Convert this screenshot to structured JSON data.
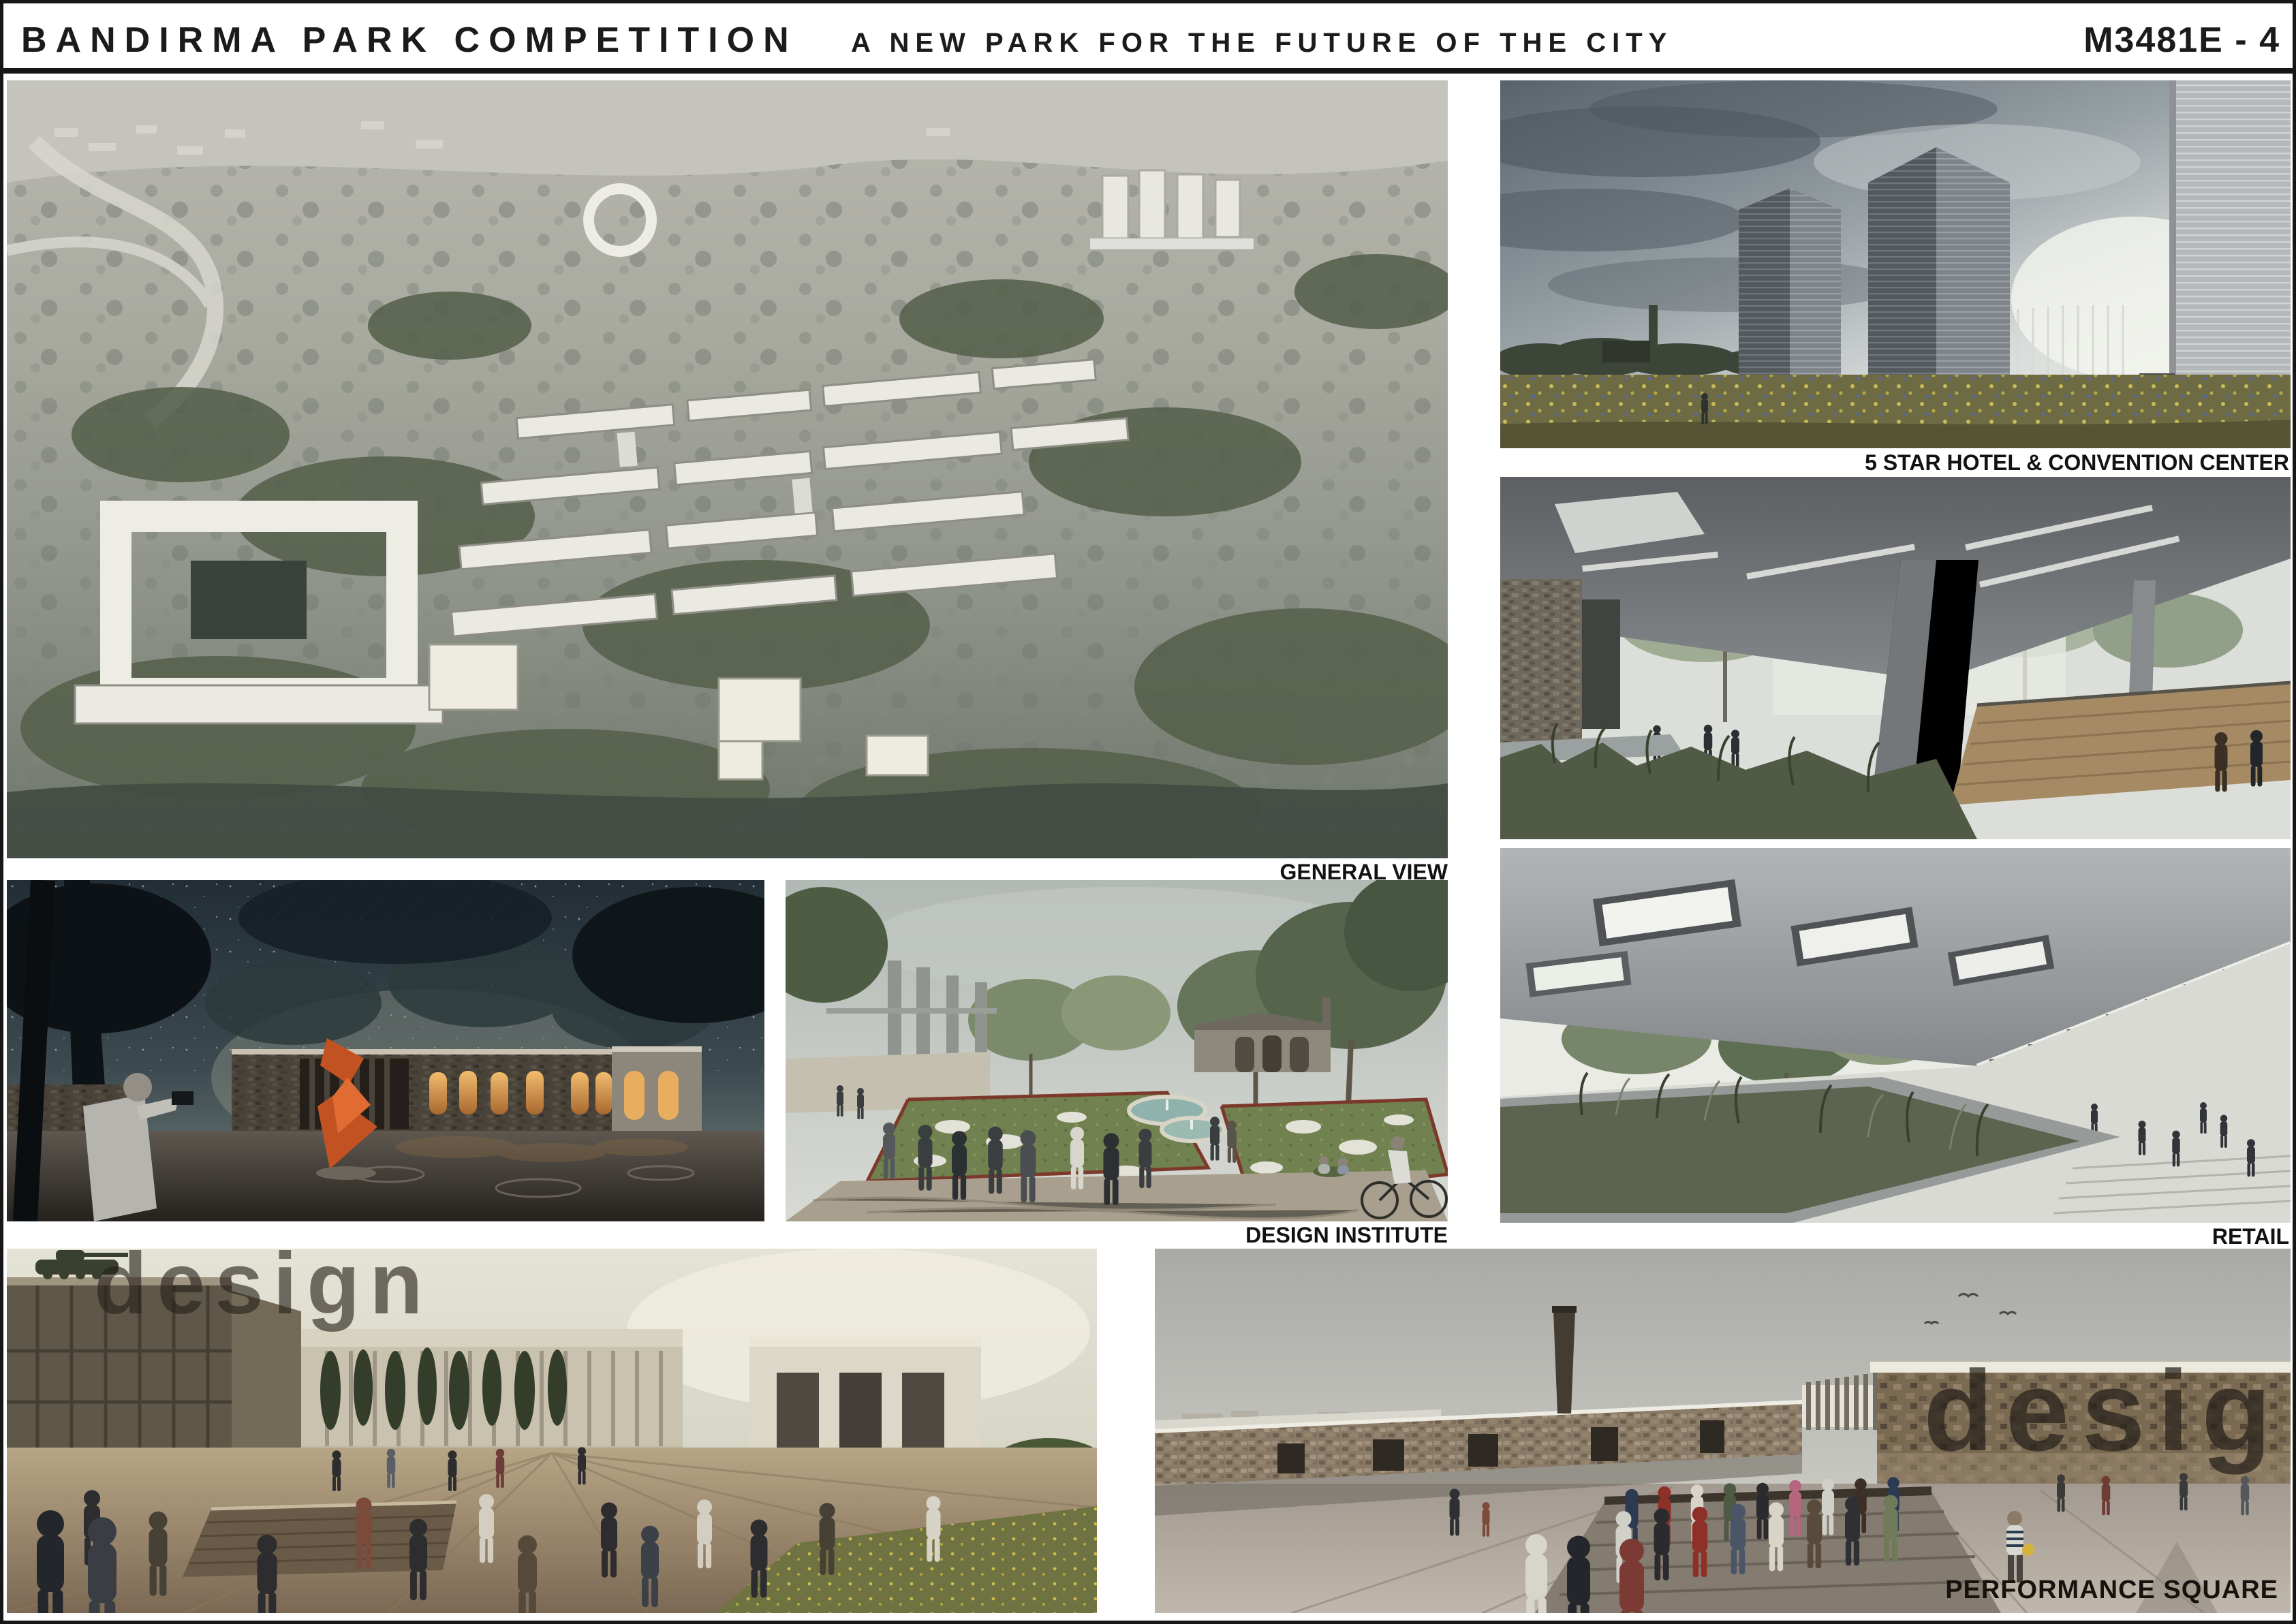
{
  "header": {
    "title": "BANDIRMA PARK COMPETITION",
    "subtitle": "A NEW PARK FOR THE FUTURE OF THE CITY",
    "entry_code": "M3481E - 4"
  },
  "panels": {
    "general_view": {
      "caption": "GENERAL VIEW"
    },
    "hotel_convention": {
      "caption": "5 STAR HOTEL & CONVENTION CENTER"
    },
    "retail": {
      "caption": "RETAIL"
    },
    "design_institute": {
      "caption": "DESIGN INSTITUTE"
    },
    "performance_square": {
      "caption": "PERFORMANCE SQUARE",
      "facade_text": "design"
    },
    "plaza": {
      "facade_text": "design"
    }
  },
  "colors": {
    "ink": "#161616",
    "sculpture_orange": "#c35222",
    "window_glow": "#e8ad5f"
  }
}
